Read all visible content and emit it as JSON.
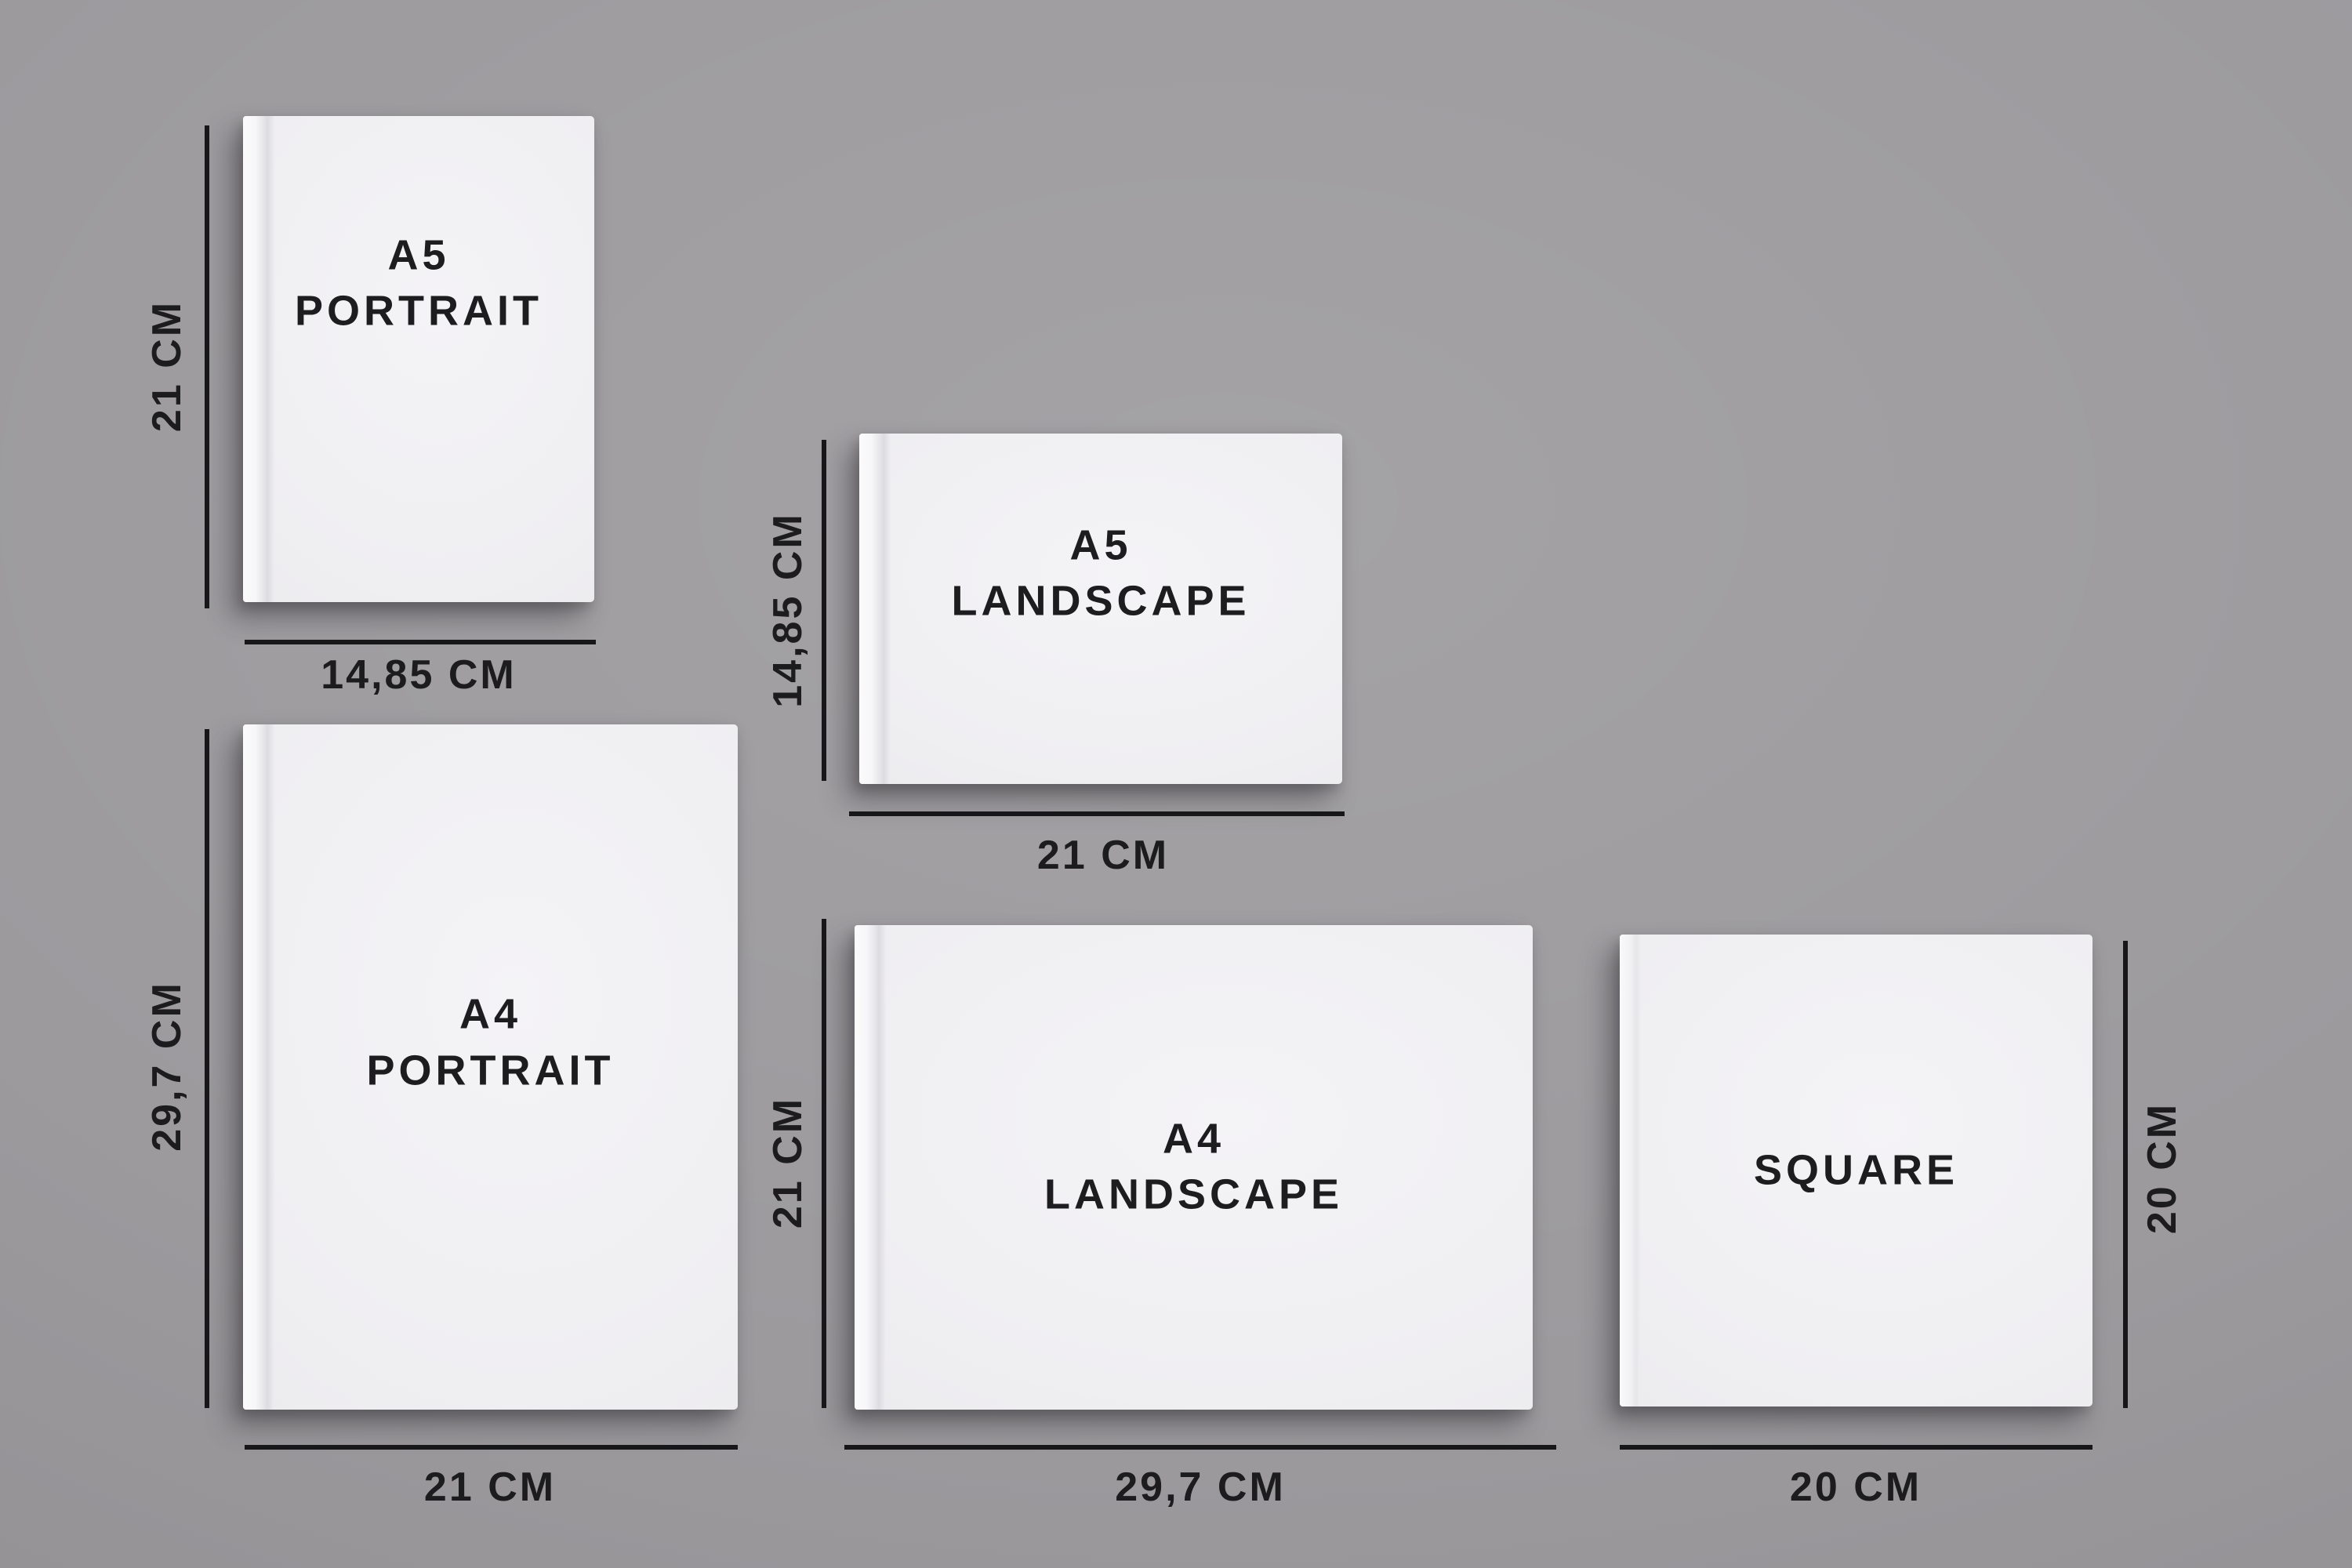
{
  "canvas": {
    "background_color": "#9a989b",
    "line_color": "#171618",
    "text_color": "#1c1b1d",
    "book_color": "#f1f0f3"
  },
  "books": [
    {
      "name": "A5 Portrait",
      "title_lines": [
        "A5",
        "PORTRAIT"
      ],
      "height_label": "21 CM",
      "width_label": "14,85 CM",
      "height_label_side": "left"
    },
    {
      "name": "A5 Landscape",
      "title_lines": [
        "A5",
        "LANDSCAPE"
      ],
      "height_label": "14,85 CM",
      "width_label": "21 CM",
      "height_label_side": "left"
    },
    {
      "name": "A4 Portrait",
      "title_lines": [
        "A4",
        "PORTRAIT"
      ],
      "height_label": "29,7 CM",
      "width_label": "21 CM",
      "height_label_side": "left"
    },
    {
      "name": "A4 Landscape",
      "title_lines": [
        "A4",
        "LANDSCAPE"
      ],
      "height_label": "21 CM",
      "width_label": "29,7 CM",
      "height_label_side": "left"
    },
    {
      "name": "Square",
      "title_lines": [
        "SQUARE"
      ],
      "height_label": "20 CM",
      "width_label": "20 CM",
      "height_label_side": "right"
    }
  ]
}
